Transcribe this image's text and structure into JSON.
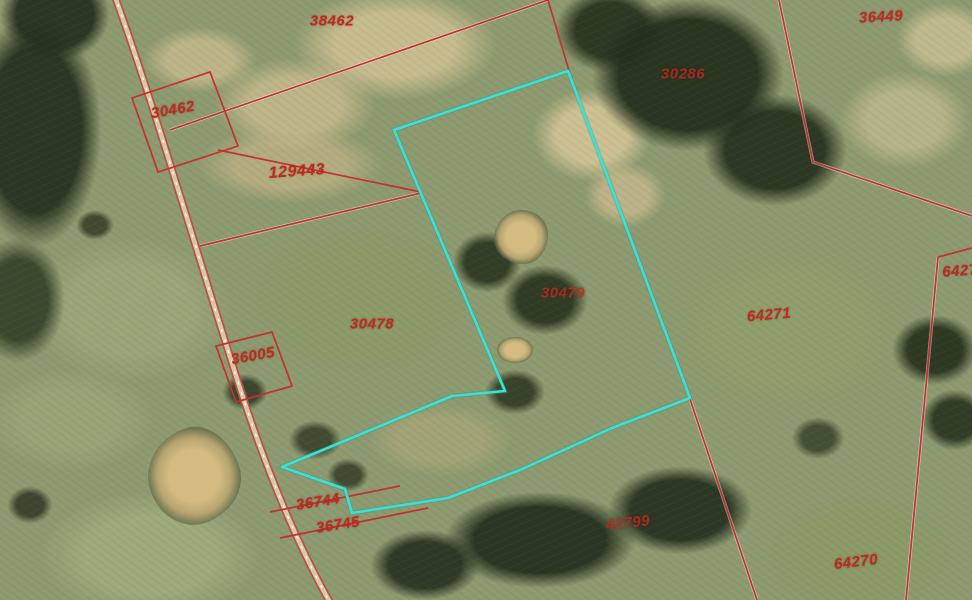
{
  "parcels": {
    "labels": [
      {
        "text": "38462"
      },
      {
        "text": "36449"
      },
      {
        "text": "30462"
      },
      {
        "text": "30286"
      },
      {
        "text": "129443"
      },
      {
        "text": "30479"
      },
      {
        "text": "30478"
      },
      {
        "text": "64271"
      },
      {
        "text": "6427"
      },
      {
        "text": "36005"
      },
      {
        "text": "36744"
      },
      {
        "text": "36745"
      },
      {
        "text": "42799"
      },
      {
        "text": "64270"
      }
    ],
    "highlighted_parcel": "30479"
  },
  "colors": {
    "boundary_line": "#c53030",
    "boundary_casing": "#ffffff",
    "highlight_outline": "#3fe0d4",
    "label_text": "#c2281e",
    "road": "#b5544a"
  }
}
